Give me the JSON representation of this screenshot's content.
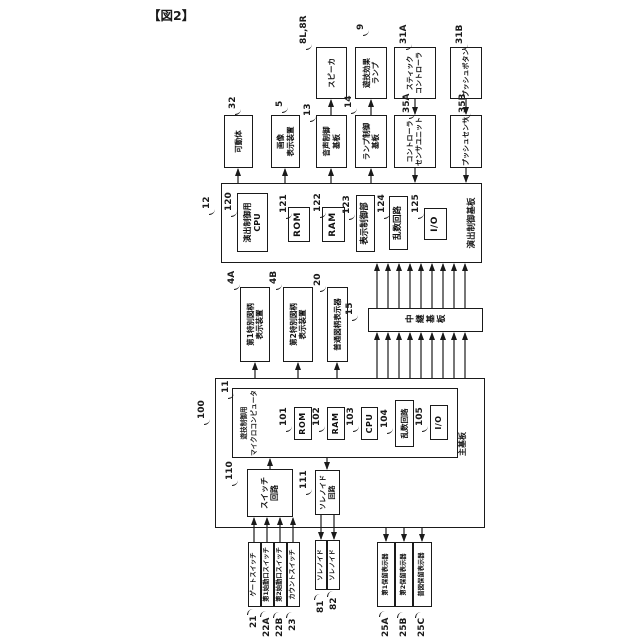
{
  "figure_label": "【図2】",
  "colors": {
    "ink": "#1a1a1a",
    "bg": "#ffffff"
  },
  "presentation_board": {
    "ref": "12",
    "name": "演出制御基板",
    "components": {
      "cpu": {
        "ref": "120",
        "label": "演出制御用\nCPU"
      },
      "rom": {
        "ref": "121",
        "label": "ROM"
      },
      "ram": {
        "ref": "122",
        "label": "RAM"
      },
      "display_ctrl": {
        "ref": "123",
        "label": "表示制御部"
      },
      "random": {
        "ref": "124",
        "label": "乱数回路"
      },
      "io": {
        "ref": "125",
        "label": "I/O"
      }
    }
  },
  "main_board": {
    "ref": "11",
    "name": "主基板",
    "micom": {
      "ref": "100",
      "label": "遊技制御用\nマイクロコンピュータ"
    },
    "components": {
      "rom": {
        "ref": "101",
        "label": "ROM"
      },
      "ram": {
        "ref": "102",
        "label": "RAM"
      },
      "cpu": {
        "ref": "103",
        "label": "CPU"
      },
      "random": {
        "ref": "104",
        "label": "乱数回路"
      },
      "io": {
        "ref": "105",
        "label": "I/O"
      }
    },
    "switch_circuit": {
      "ref": "110",
      "label": "スイッチ\n回路"
    },
    "solenoid_circuit": {
      "ref": "111",
      "label": "ソレノイド\n回路"
    }
  },
  "relay_board": {
    "ref": "15",
    "label": "中継基板"
  },
  "symbol_displays": [
    {
      "ref": "4A",
      "label": "第1特別図柄\n表示装置"
    },
    {
      "ref": "4B",
      "label": "第2特別図柄\n表示装置"
    },
    {
      "ref": "20",
      "label": "普通図柄表示器"
    }
  ],
  "sub_boards": [
    {
      "ref": "32",
      "label": "可動体"
    },
    {
      "ref": "5",
      "label": "画像\n表示装置"
    },
    {
      "ref": "13",
      "label": "音声制御\n基板"
    },
    {
      "ref": "14",
      "label": "ランプ制御\n基板"
    },
    {
      "ref": "35A",
      "label": "コントローラ\nセンサユニット"
    },
    {
      "ref": "35B",
      "label": "プッシュセンサ"
    }
  ],
  "devices": [
    {
      "ref": "8L,8R",
      "label": "スピーカ"
    },
    {
      "ref": "9",
      "label": "遊技効果\nランプ"
    },
    {
      "ref": "31A",
      "label": "スティック\nコントローラ"
    },
    {
      "ref": "31B",
      "label": "プッシュボタン"
    }
  ],
  "switches": [
    {
      "ref": "21",
      "label": "ゲートスイッチ"
    },
    {
      "ref": "22A",
      "label": "第1始動口スイッチ"
    },
    {
      "ref": "22B",
      "label": "第2始動口スイッチ"
    },
    {
      "ref": "23",
      "label": "カウントスイッチ"
    }
  ],
  "solenoids": [
    {
      "ref": "81",
      "label": "ソレノイド"
    },
    {
      "ref": "82",
      "label": "ソレノイド"
    }
  ],
  "hold_displays": [
    {
      "ref": "25A",
      "label": "第1保留表示器"
    },
    {
      "ref": "25B",
      "label": "第2保留表示器"
    },
    {
      "ref": "25C",
      "label": "普図保留表示器"
    }
  ]
}
